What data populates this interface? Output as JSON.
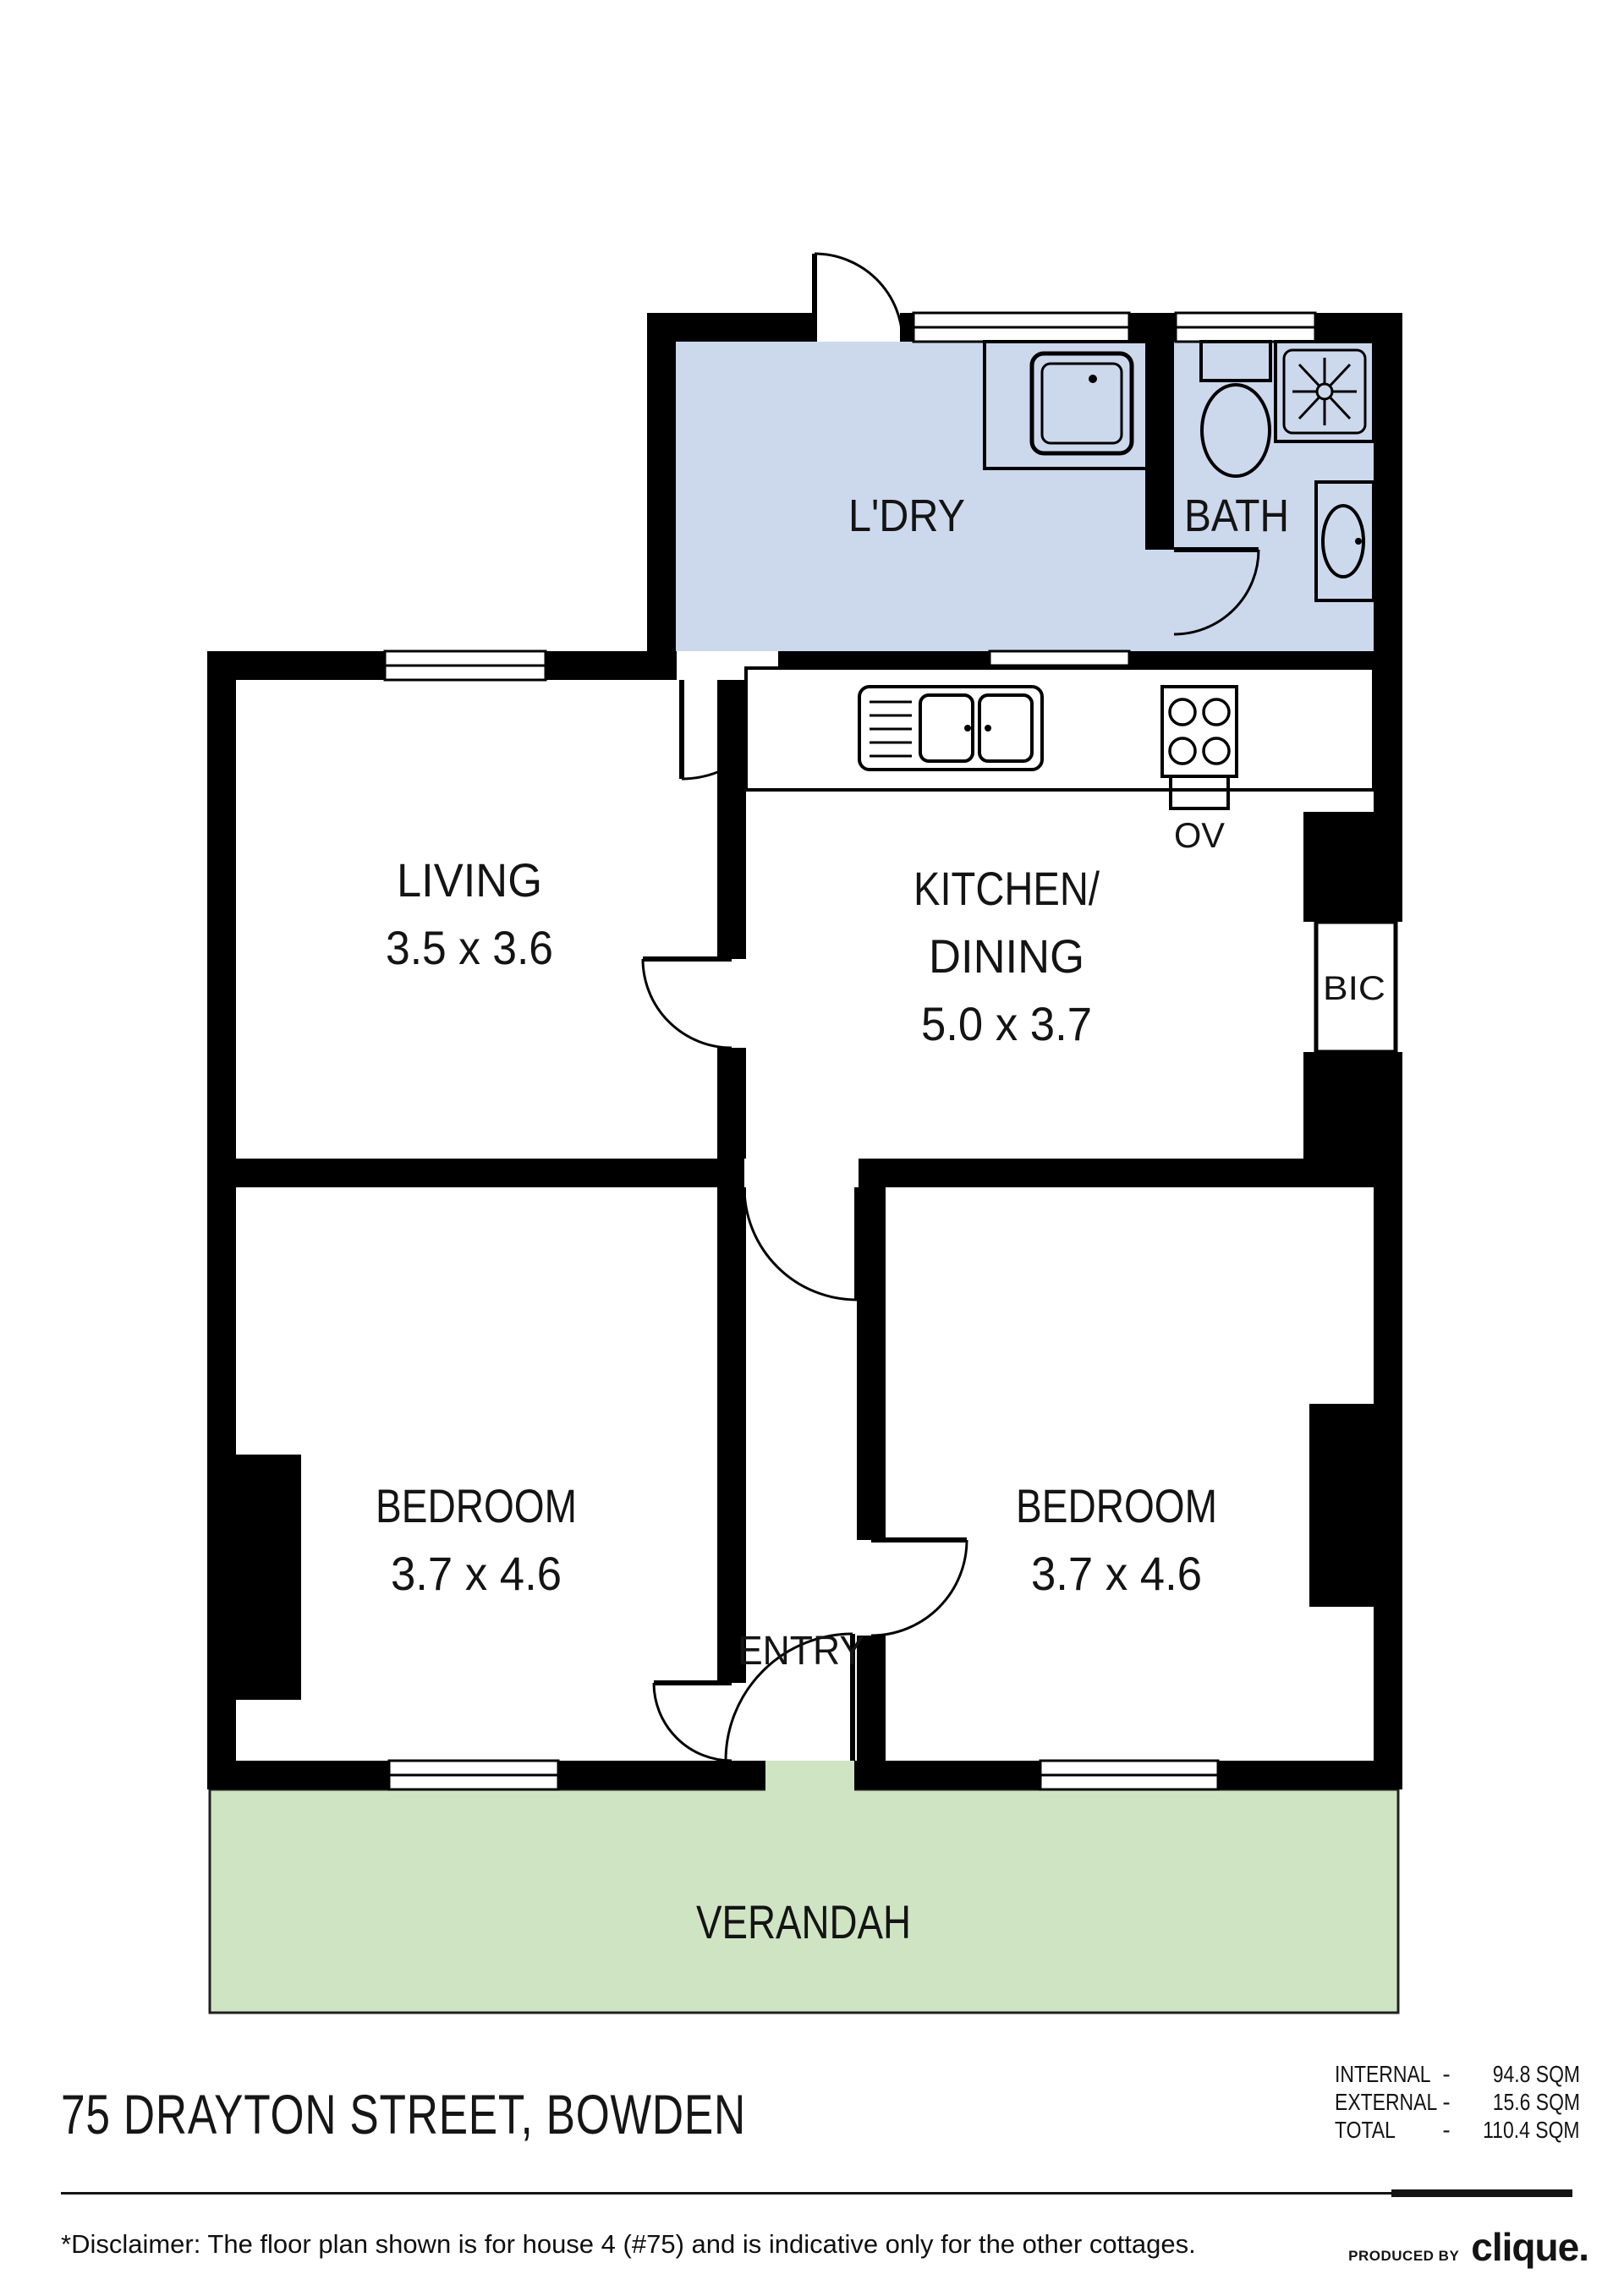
{
  "plan": {
    "colors": {
      "wet_area": "#ccd8ec",
      "verandah_fill": "#cfe4c3",
      "wall": "#000000"
    },
    "rooms": {
      "laundry": {
        "label": "L'DRY"
      },
      "bath": {
        "label": "BATH"
      },
      "living": {
        "label": "LIVING",
        "dims": "3.5 x 3.6"
      },
      "kitchen": {
        "label1": "KITCHEN/",
        "label2": "DINING",
        "dims": "5.0 x 3.7"
      },
      "bic": {
        "label": "BIC"
      },
      "oven": {
        "label": "OV"
      },
      "bedroom_left": {
        "label": "BEDROOM",
        "dims": "3.7 x 4.6"
      },
      "bedroom_right": {
        "label": "BEDROOM",
        "dims": "3.7 x 4.6"
      },
      "entry": {
        "label": "ENTRY"
      },
      "verandah": {
        "label": "VERANDAH"
      }
    }
  },
  "footer": {
    "address": "75 DRAYTON STREET, BOWDEN",
    "areas": [
      {
        "label": "INTERNAL",
        "sep": "-",
        "value": "94.8 SQM"
      },
      {
        "label": "EXTERNAL",
        "sep": "-",
        "value": "15.6 SQM"
      },
      {
        "label": "TOTAL",
        "sep": "-",
        "value": "110.4 SQM"
      }
    ],
    "disclaimer": "*Disclaimer: The floor plan shown is for house 4 (#75) and is indicative only for the other cottages.",
    "produced_by_label": "PRODUCED BY",
    "brand": "clique."
  }
}
